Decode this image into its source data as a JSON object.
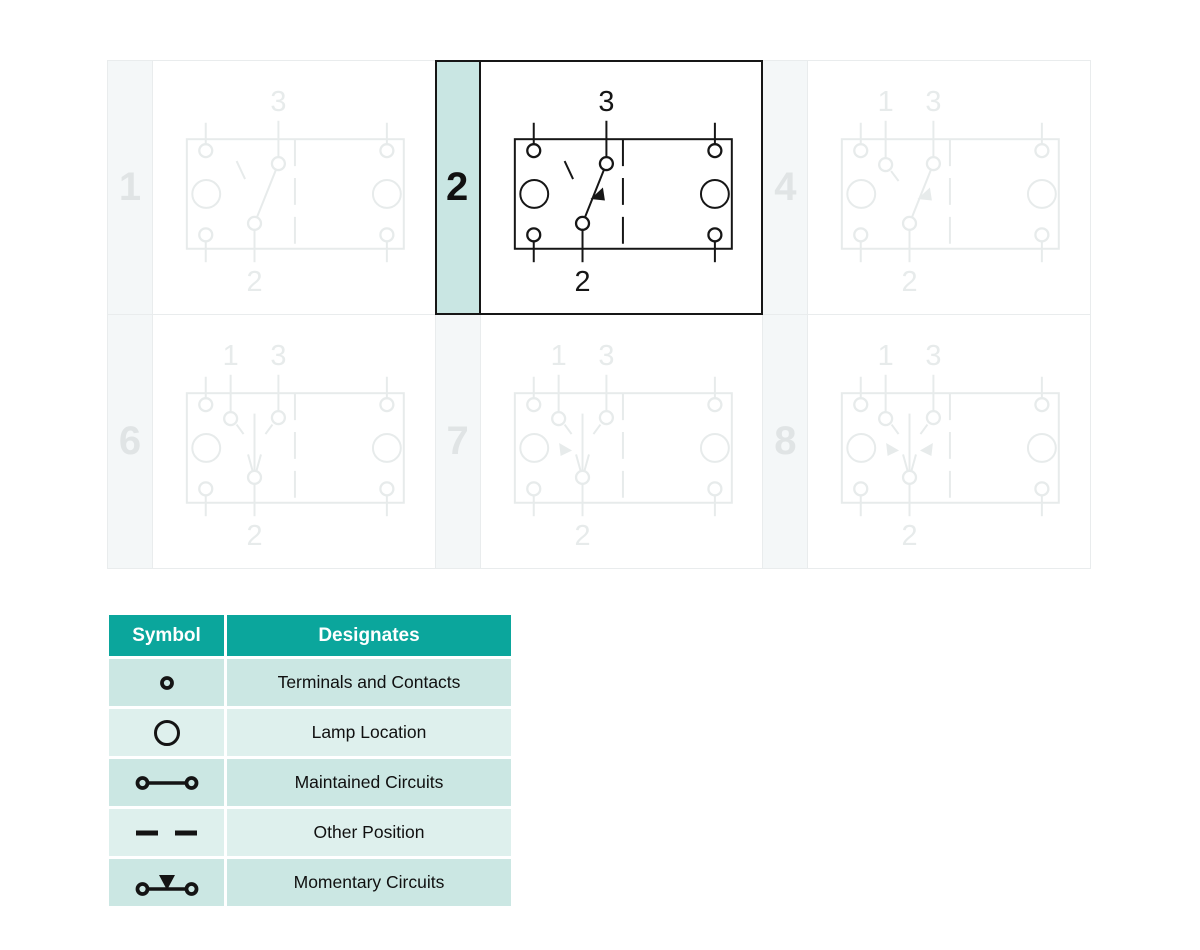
{
  "grid": {
    "cells": [
      {
        "number": "1",
        "top_labels": [
          "3"
        ],
        "bottom_label": "2",
        "variant": "angled",
        "arrows": [],
        "active": false
      },
      {
        "number": "2",
        "top_labels": [
          "3"
        ],
        "bottom_label": "2",
        "variant": "angled",
        "arrows": [
          "lever"
        ],
        "active": true
      },
      {
        "number": "4",
        "top_labels": [
          "1",
          "3"
        ],
        "bottom_label": "2",
        "variant": "angled",
        "arrows": [
          "lever"
        ],
        "active": false
      },
      {
        "number": "6",
        "top_labels": [
          "1",
          "3"
        ],
        "bottom_label": "2",
        "variant": "center",
        "arrows": [],
        "active": false
      },
      {
        "number": "7",
        "top_labels": [
          "1",
          "3"
        ],
        "bottom_label": "2",
        "variant": "center",
        "arrows": [
          "left"
        ],
        "active": false
      },
      {
        "number": "8",
        "top_labels": [
          "1",
          "3"
        ],
        "bottom_label": "2",
        "variant": "center",
        "arrows": [
          "left",
          "right"
        ],
        "active": false
      }
    ]
  },
  "legend": {
    "headers": [
      "Symbol",
      "Designates"
    ],
    "rows": [
      {
        "symbol": "terminal-contact-icon",
        "label": "Terminals and Contacts"
      },
      {
        "symbol": "lamp-location-icon",
        "label": "Lamp Location"
      },
      {
        "symbol": "maintained-circuit-icon",
        "label": "Maintained Circuits"
      },
      {
        "symbol": "other-position-icon",
        "label": "Other Position"
      },
      {
        "symbol": "momentary-circuit-icon",
        "label": "Momentary Circuits"
      }
    ]
  },
  "colors": {
    "header_teal": "#0ba69c",
    "row_tint_dark": "#cbe7e3",
    "row_tint_light": "#def0ed",
    "active_tab_teal": "#c9e6e3",
    "active_line": "#161616",
    "grid_line": "#e9eced",
    "inactive_tab_bg": "#f4f7f8",
    "inactive_number": "#e0e4e5"
  }
}
